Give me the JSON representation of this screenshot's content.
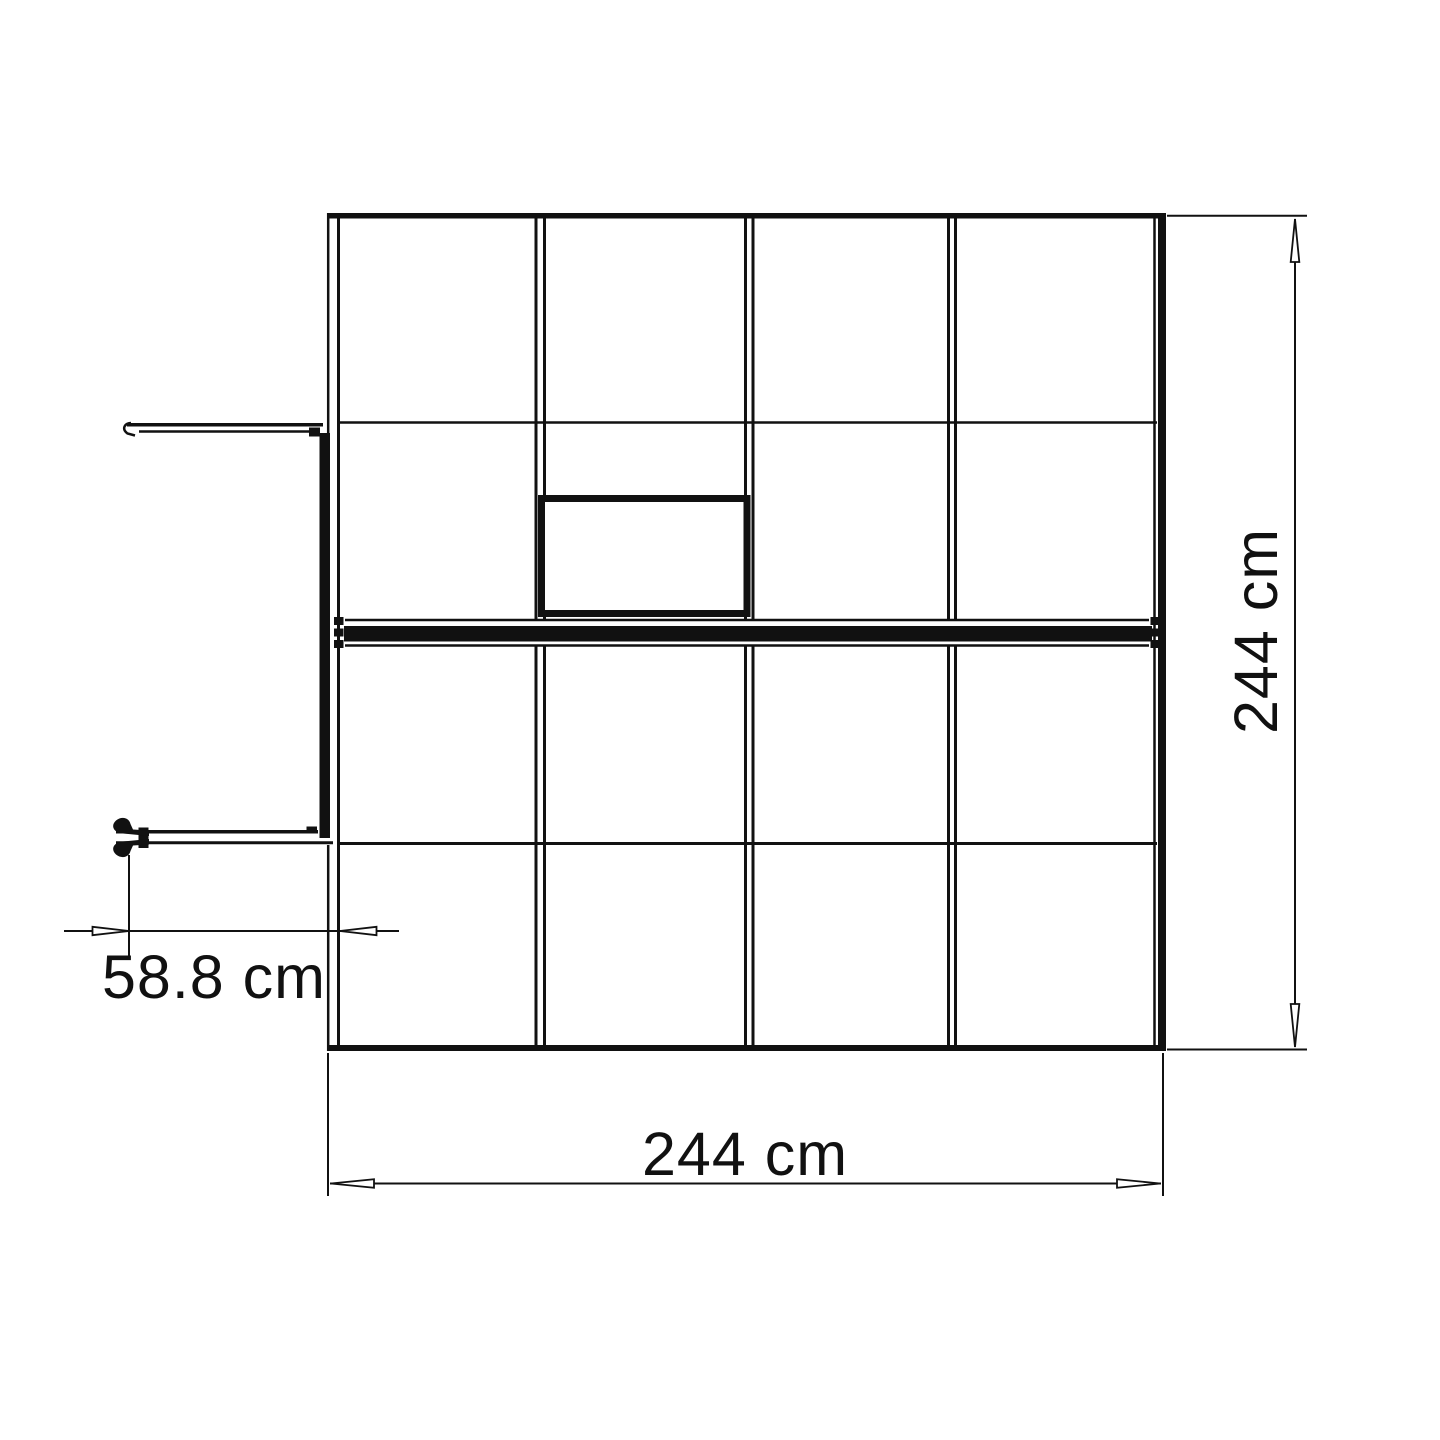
{
  "page": {
    "background": "#ffffff"
  },
  "drawing": {
    "type": "greenhouse-top-view-plan",
    "line_color": "#111111",
    "labels": {
      "height": "244 cm",
      "width": "244 cm",
      "door_width": "58.8 cm"
    }
  }
}
